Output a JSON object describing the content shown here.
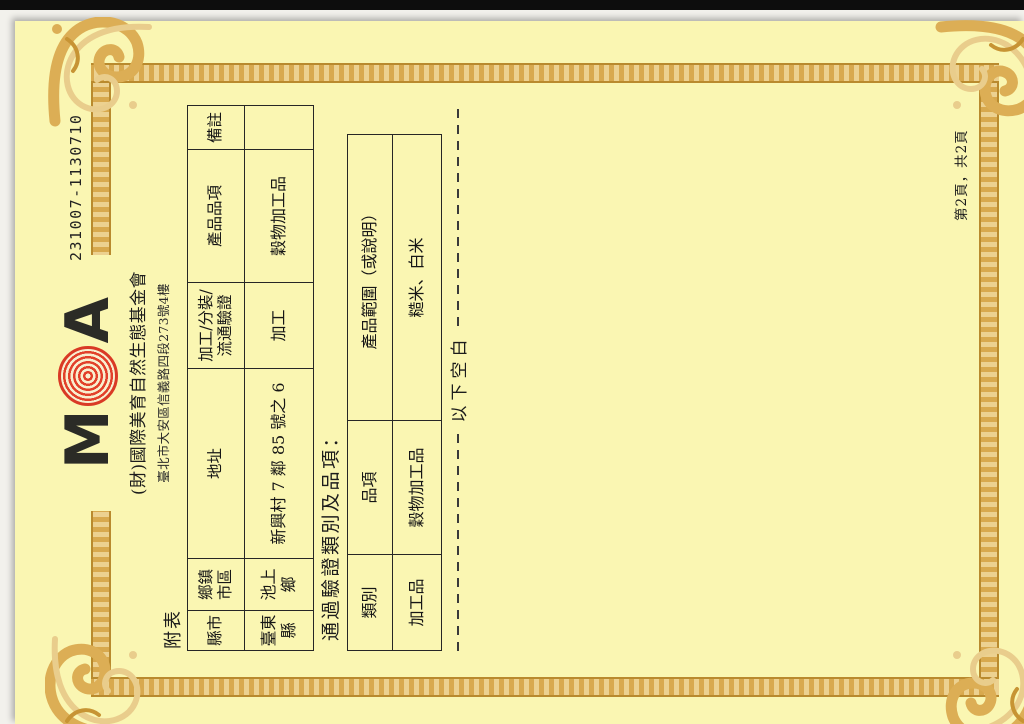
{
  "scan": {
    "paper_color": "#faf6b2",
    "frame_gold_color": "#dcae55",
    "logo_red_color": "#dd3c26",
    "scanner_strip_color": "#0d0d0d",
    "ink_color": "#1c1c1c"
  },
  "document": {
    "certificate_number": "231007-1130710",
    "appendix_label": "附表",
    "header": {
      "logo_m": "M",
      "logo_a": "A",
      "org_name": "(財)國際美育自然生態基金會",
      "org_address": "臺北市大安區信義路四段273號4樓"
    },
    "facility_table": {
      "headers": [
        "縣市",
        "鄉鎮市區",
        "地址",
        "加工/分裝/流通驗證",
        "產品品項",
        "備註"
      ],
      "row": [
        "臺東縣",
        "池上鄉",
        "新興村 7 鄰 85 號之 6",
        "加工",
        "穀物加工品",
        ""
      ]
    },
    "certified_section": {
      "title": "通過驗證類別及品項：",
      "table": {
        "headers": [
          "類別",
          "品項",
          "產品範圍（或說明）"
        ],
        "row": [
          "加工品",
          "穀物加工品",
          "糙米、白米"
        ]
      },
      "blank_below_label": "以下空白"
    },
    "page_label": "第2頁，共2頁"
  }
}
